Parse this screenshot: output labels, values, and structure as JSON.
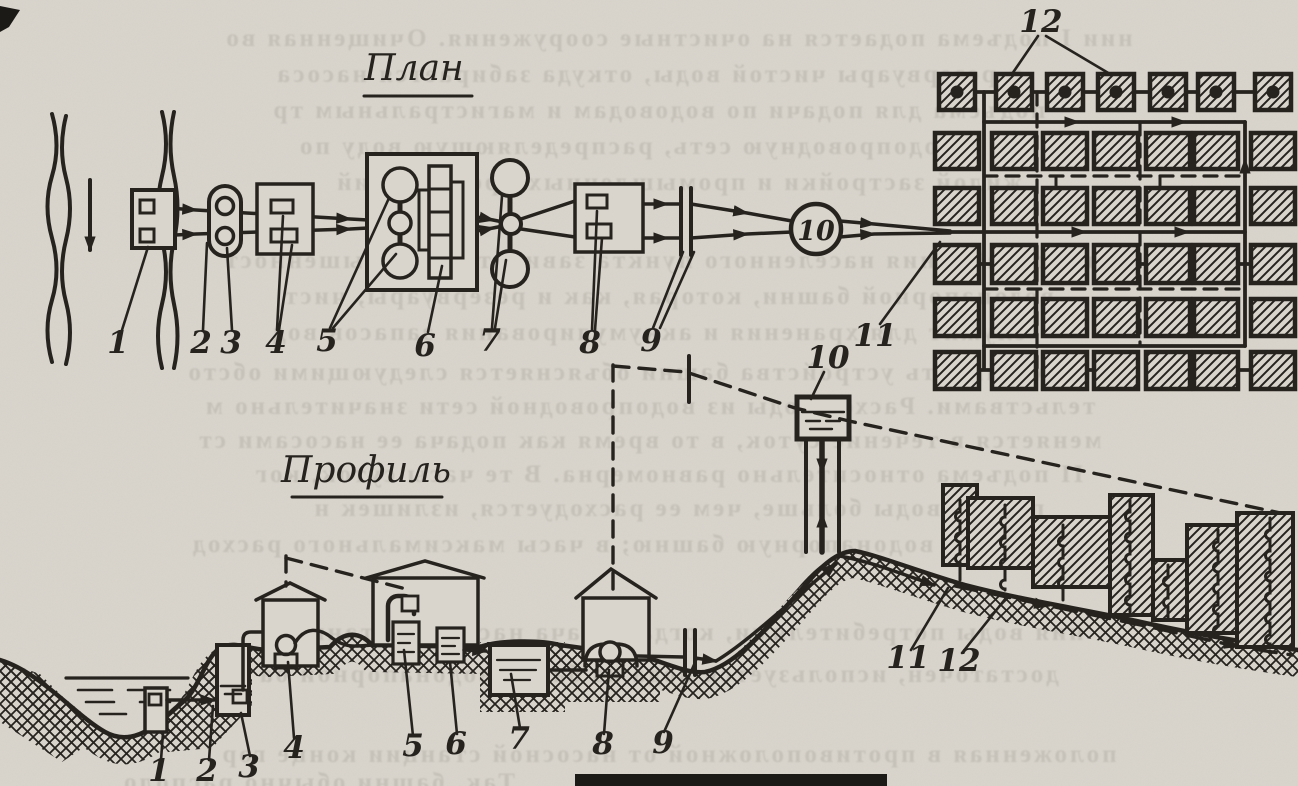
{
  "figure_labels": {
    "plan_title": "План",
    "profile_title": "Профиль"
  },
  "plan": {
    "numbers": [
      "1",
      "2",
      "3",
      "4",
      "5",
      "6",
      "7",
      "8",
      "9"
    ],
    "water_tower_number": "10",
    "conduit_number": "11",
    "network_number": "12",
    "city_grid": {
      "columns": 7,
      "rows": 6,
      "first_row_has_dots": true
    }
  },
  "profile": {
    "numbers": [
      "1",
      "2",
      "3",
      "4",
      "5",
      "6",
      "7",
      "8",
      "9"
    ],
    "water_tower_number": "10",
    "main_number": "11",
    "network_number": "12"
  },
  "colors": {
    "paper": "#d9d5cd",
    "ink": "#26231f",
    "bleed": "#6f6a5f"
  },
  "bleed_text": {
    "lines": [
      "нии I подъема подается на очистные сооружения. Очищенная во",
      "в резервуары чистой воды, откуда забирается насоса",
      "подъема для подачи по водоводам и магистральным тр",
      "в водопроводную сеть, распределяющую воду по",
      "жилой застройки и промышленных предприятий",
      "водоснабжения населенного пункта зависит на возвышенност",
      "водонапорной башни, которая, как и резервуары, чист",
      "служит для хранения и аккумулирования запасов вод",
      "Необходимость устройства башни объясняется следующими обсто",
      "тельствами. Расход воды из водопроводной сети значительно м",
      "меняется в течение суток, в то время как подача ее насосами ст",
      "II подъема относительно равномерна. В те часы суток, ког",
      "подача воды больше, чем ее расходуется, излишек н",
      "поступает в водонапорную башню; в часы максимального расход",
      "ния воды потребителями, когда подача насосной станции",
      "достаточен, используется вода из баков водонапорной ба",
      "положенная в противоположной от насосной станции конце гор",
      "Так, башни обычно располо"
    ]
  }
}
